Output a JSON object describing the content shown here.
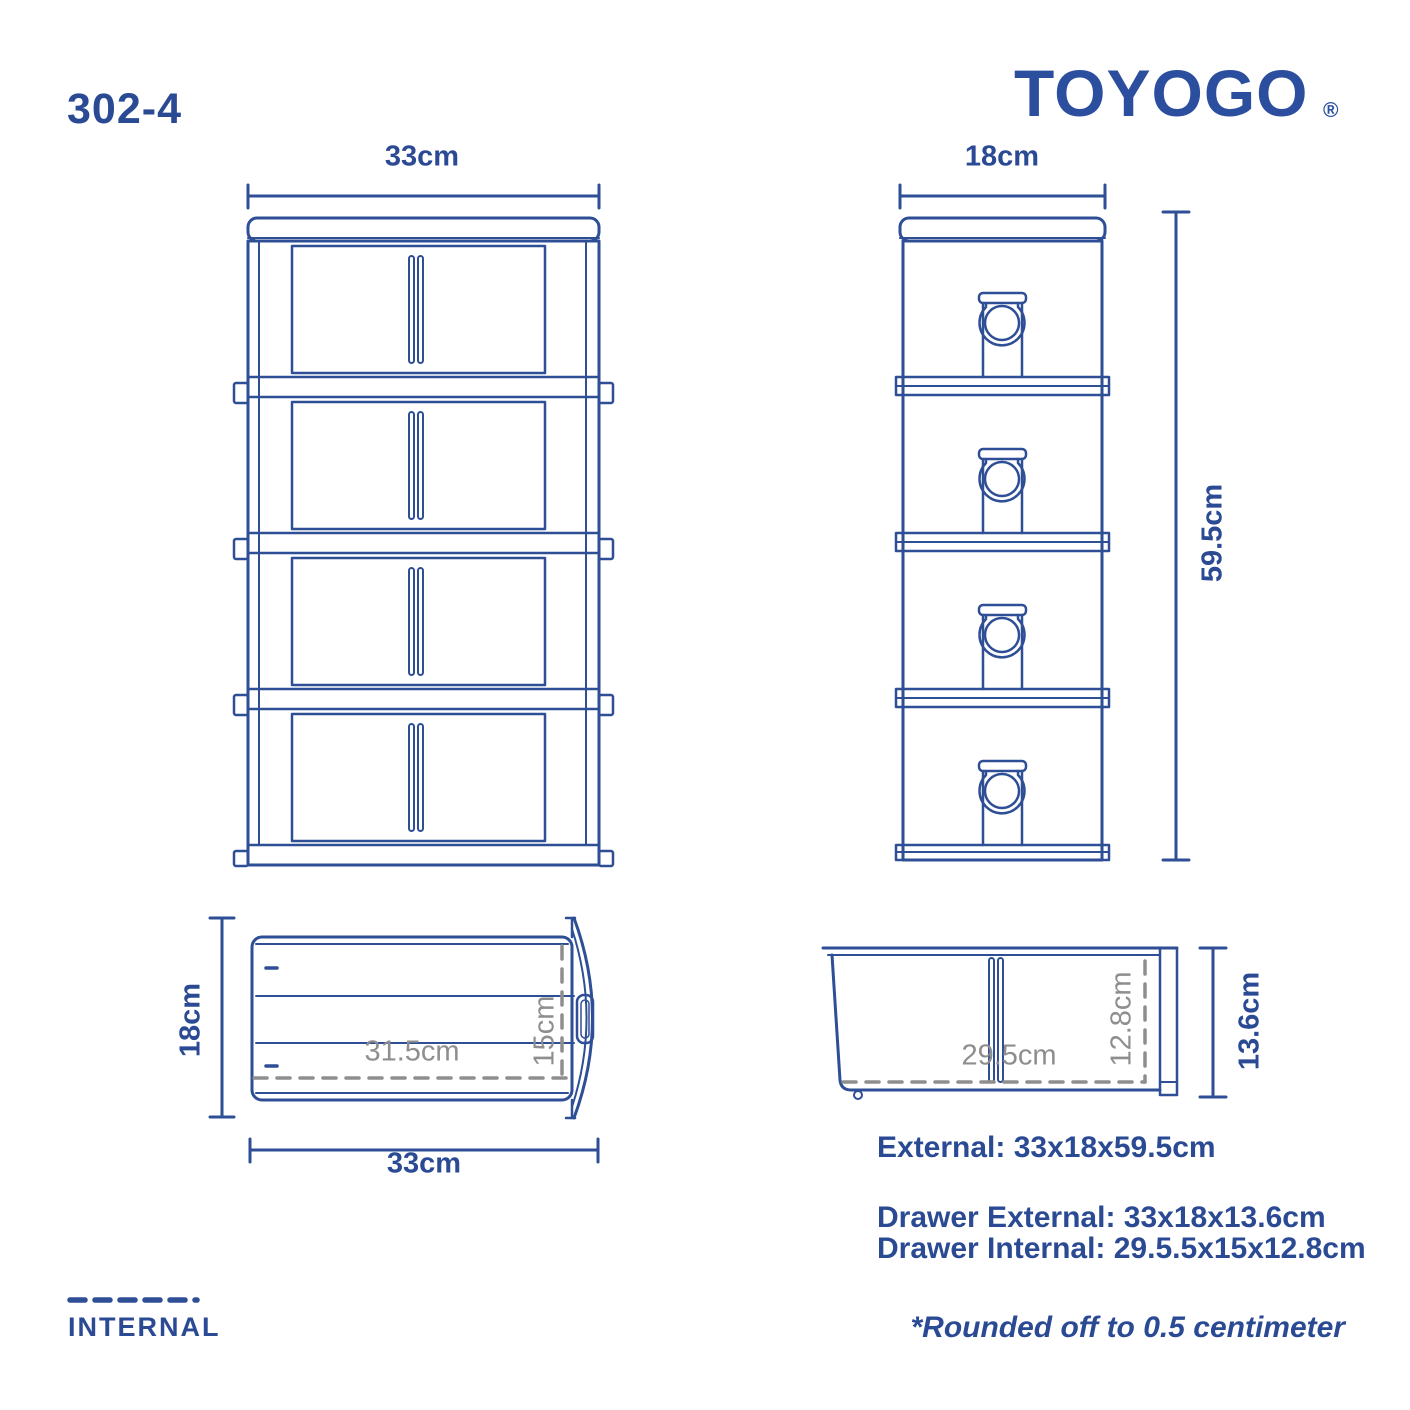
{
  "header": {
    "model": "302-4",
    "brand": "TOYOGO",
    "registered": "®"
  },
  "colors": {
    "line_blue": "#2E4E96",
    "text_blue": "#2B4A94",
    "logo_blue": "#2B4F9E",
    "internal_gray": "#8E8E8E"
  },
  "front_view": {
    "width": "33cm"
  },
  "side_view": {
    "width": "18cm",
    "height": "59.5cm"
  },
  "drawer_top_view": {
    "depth": "18cm",
    "width": "33cm",
    "internal_width": "31.5cm",
    "internal_depth": "15cm"
  },
  "drawer_side_view": {
    "internal_width": "29.5cm",
    "internal_height": "12.8cm",
    "external_height": "13.6cm"
  },
  "specs": {
    "external": "External: 33x18x59.5cm",
    "drawer_external": "Drawer External: 33x18x13.6cm",
    "drawer_internal": "Drawer Internal: 29.5.5x15x12.8cm"
  },
  "legend": {
    "internal": "INTERNAL"
  },
  "footnote": "*Rounded off to 0.5 centimeter"
}
